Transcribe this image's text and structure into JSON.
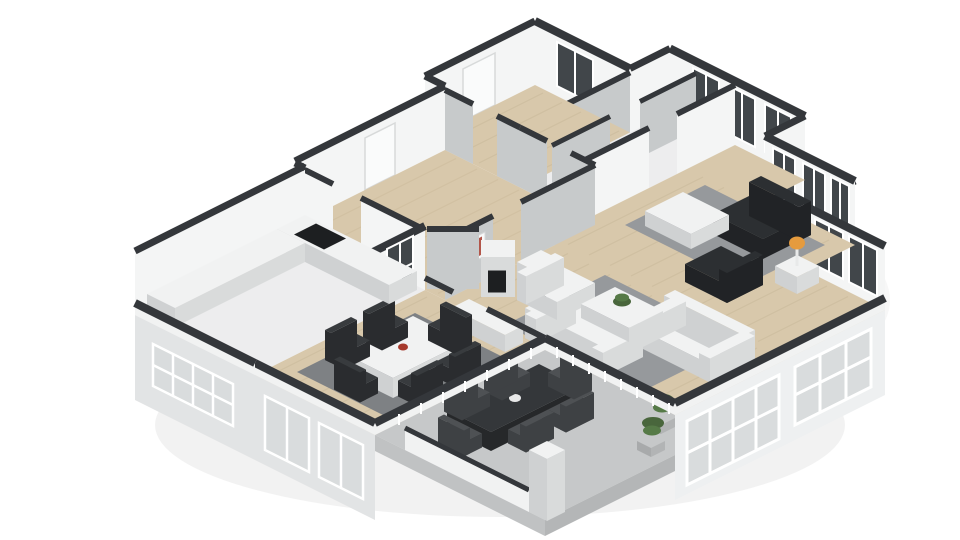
{
  "scene": {
    "label": "3D isometric floor plan rendering of a single-storey home",
    "rooms": [
      {
        "name": "entry-hall"
      },
      {
        "name": "closets"
      },
      {
        "name": "corridor"
      },
      {
        "name": "lounge"
      },
      {
        "name": "living-room"
      },
      {
        "name": "dining-room"
      },
      {
        "name": "kitchen"
      },
      {
        "name": "patio"
      }
    ],
    "furniture": [
      "dark-armchair",
      "dark-lounge-chair",
      "lounge-coffee-table",
      "side-table",
      "orange-lamp",
      "white-sofa",
      "white-loveseat",
      "white-armchair",
      "living-coffee-table",
      "potted-plant",
      "fireplace",
      "china-cabinet",
      "dining-table",
      "dining-chairs",
      "red-centerpiece",
      "sideboard",
      "wall-art",
      "kitchen-counter",
      "cooktop",
      "outdoor-dining-table",
      "outdoor-chairs",
      "patio-plants",
      "patio-pillar",
      "patio-low-wall"
    ]
  },
  "palette": {
    "bg": "#ffffff",
    "wallTop": "#34373b",
    "slab": "#f4f5f5",
    "slabGray": "#c7cacb",
    "wood": "#d8c8ab",
    "woodLine": "#bfae8e",
    "whiteFloor": "#ededee",
    "patio": "#c6c8c9",
    "plinthE": "#b4b6b7",
    "plinthS": "#c0c2c3",
    "rug": "#96999c",
    "rugDark": "#7e8184",
    "faceSE": "#eef0f1",
    "faceSW": "#e2e4e5",
    "dark": "#2c2f32",
    "darkSide": "#212326",
    "chair": "#383b3e",
    "chairSide": "#2a2c2f",
    "outChair": "#4e5154",
    "outChairSide": "#3e4144",
    "white": "#f1f2f2",
    "whiteSide": "#d9dbdb",
    "whiteSide2": "#cfd1d2",
    "glassDark": "#41464a",
    "glassLight": "#d9dcdd",
    "frame": "#ffffff",
    "plant": "#567a47",
    "plantDark": "#49663c",
    "lamp": "#e59b3e",
    "red": "#a6392c",
    "artBlue": "#5b6b8a",
    "fireboxDark": "#1d1f21",
    "shadow": "#000000"
  }
}
